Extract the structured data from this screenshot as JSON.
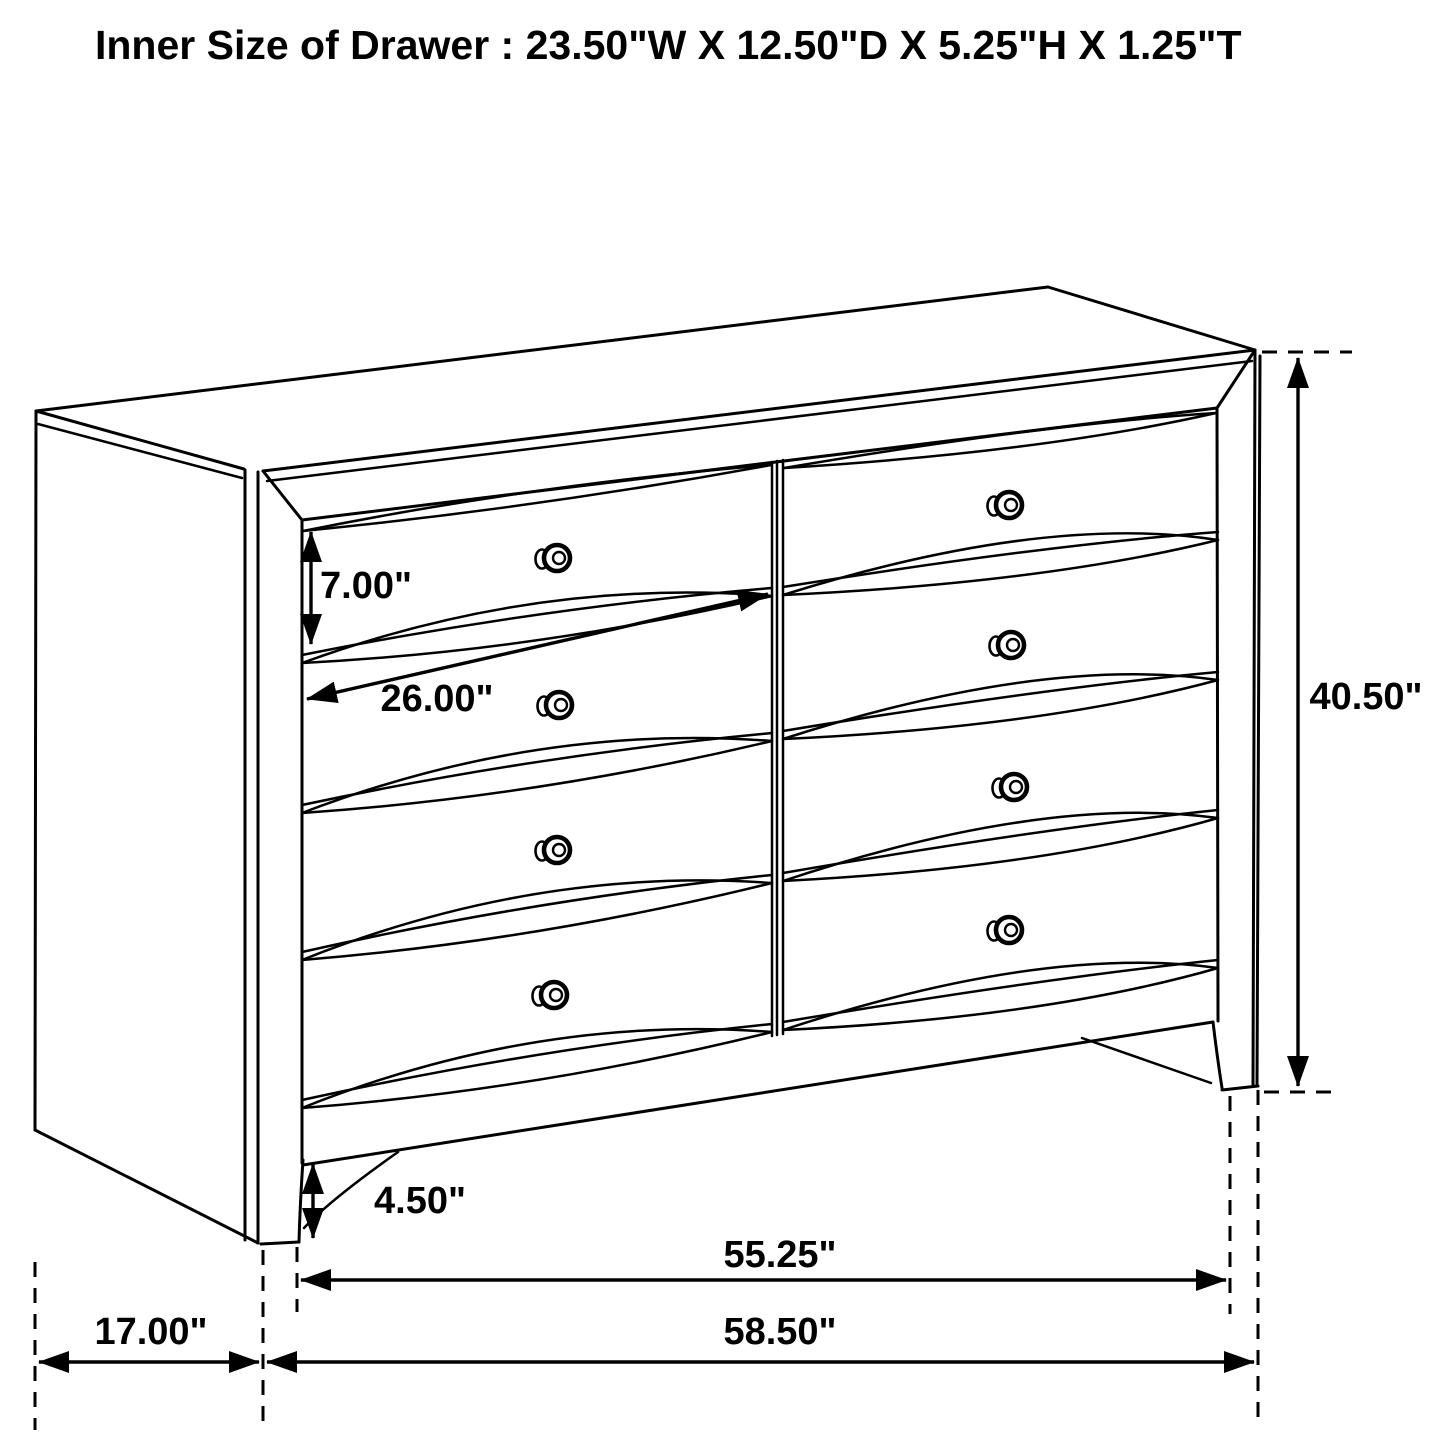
{
  "title": "Inner Size of Drawer : 23.50\"W X 12.50\"D X 5.25\"H X 1.25\"T",
  "inner_drawer_size": {
    "width": "23.50\"W",
    "depth": "12.50\"D",
    "height": "5.25\"H",
    "thickness": "1.25\"T"
  },
  "dimensions": {
    "drawer_front_height": "7.00\"",
    "drawer_width": "26.00\"",
    "overall_height": "40.50\"",
    "foot_clearance": "4.50\"",
    "front_width": "55.25\"",
    "overall_width": "58.50\"",
    "depth": "17.00\""
  },
  "figure": {
    "drawer_columns": 2,
    "drawer_rows": 4,
    "knob_count": 8
  },
  "colors": {
    "line": "#000000",
    "background": "#ffffff",
    "text": "#000000"
  }
}
